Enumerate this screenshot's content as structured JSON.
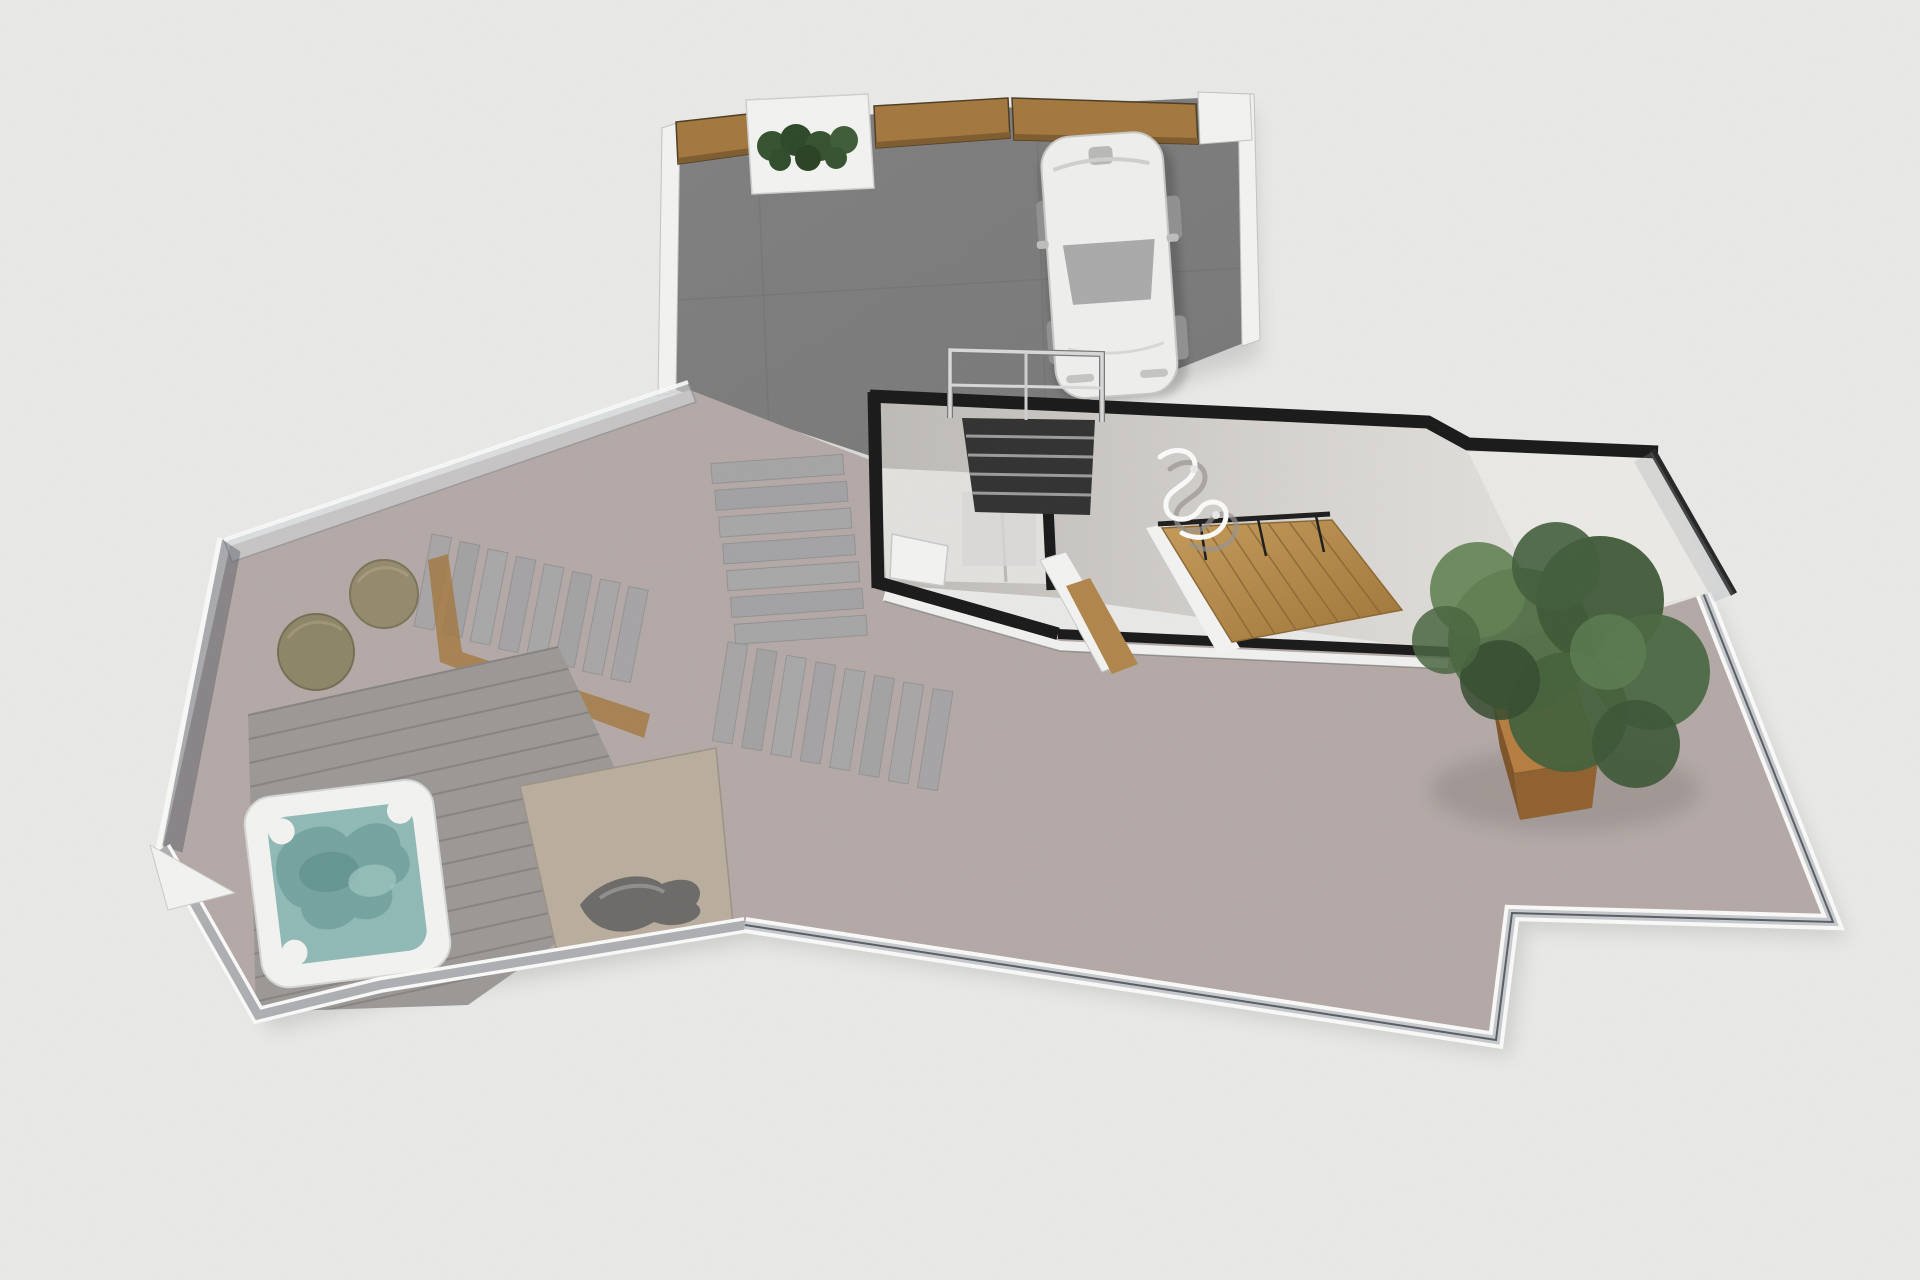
{
  "scene": {
    "type": "3d-floor-plan-render",
    "level": "roof-terrace-level",
    "objects": [
      "upper-terrace-dark-paving",
      "wood-privacy-fence",
      "hedge-planter",
      "parked-car",
      "exterior-stairwell-railing",
      "interior-entry-room",
      "interior-hall",
      "wooden-staircase",
      "ceiling-lamp",
      "main-terrace-paving",
      "paver-walkway",
      "wood-deck",
      "hot-tub",
      "poufs",
      "lounge-rug",
      "towel-object",
      "potted-tree",
      "glass-railing"
    ]
  },
  "palette": {
    "background": "#e9e9e8",
    "terrace_dark": "#7b7b7b",
    "terrace_dark_light": "#8a8a8a",
    "terrace_paving": "#b3a8a5",
    "interior_wall": "#161616",
    "interior_floor": "#d8d5d1",
    "interior_floor_light": "#eceae6",
    "entry_floor": "#e2e1de",
    "white_trim": "#f3f3f1",
    "wood_fence": "#a2763c",
    "wood_fence_dark": "#7d5a2c",
    "stair_wood": "#bb8c4c",
    "stair_wood_dark": "#8a6531",
    "planter_wood_top": "#b57c3e",
    "planter_wood_side": "#8f5f2c",
    "deck_wood": "#9b9794",
    "deck_plank_line": "#807d7a",
    "hot_tub_shell": "#f3f3f1",
    "hot_tub_water": "#8fb9b5",
    "hot_tub_seat": "#6f9f9b",
    "foliage_dark": "#3c5634",
    "foliage_mid": "#4d6a42",
    "foliage_light": "#5f7f50",
    "hedge_green": "#32502c",
    "car_body": "#efefed",
    "car_glass": "#a9a9a9",
    "glass_light": "#d3d7da",
    "glass_dark": "#4d525c",
    "railing_metal": "#d8d8d8",
    "rug": "#b9ad9d",
    "towel": "#6b6966",
    "pouf": "#93896a",
    "pouf_dark": "#7a7157",
    "paver": "#a4a4a6",
    "stair_void": "#2f2f2f"
  }
}
